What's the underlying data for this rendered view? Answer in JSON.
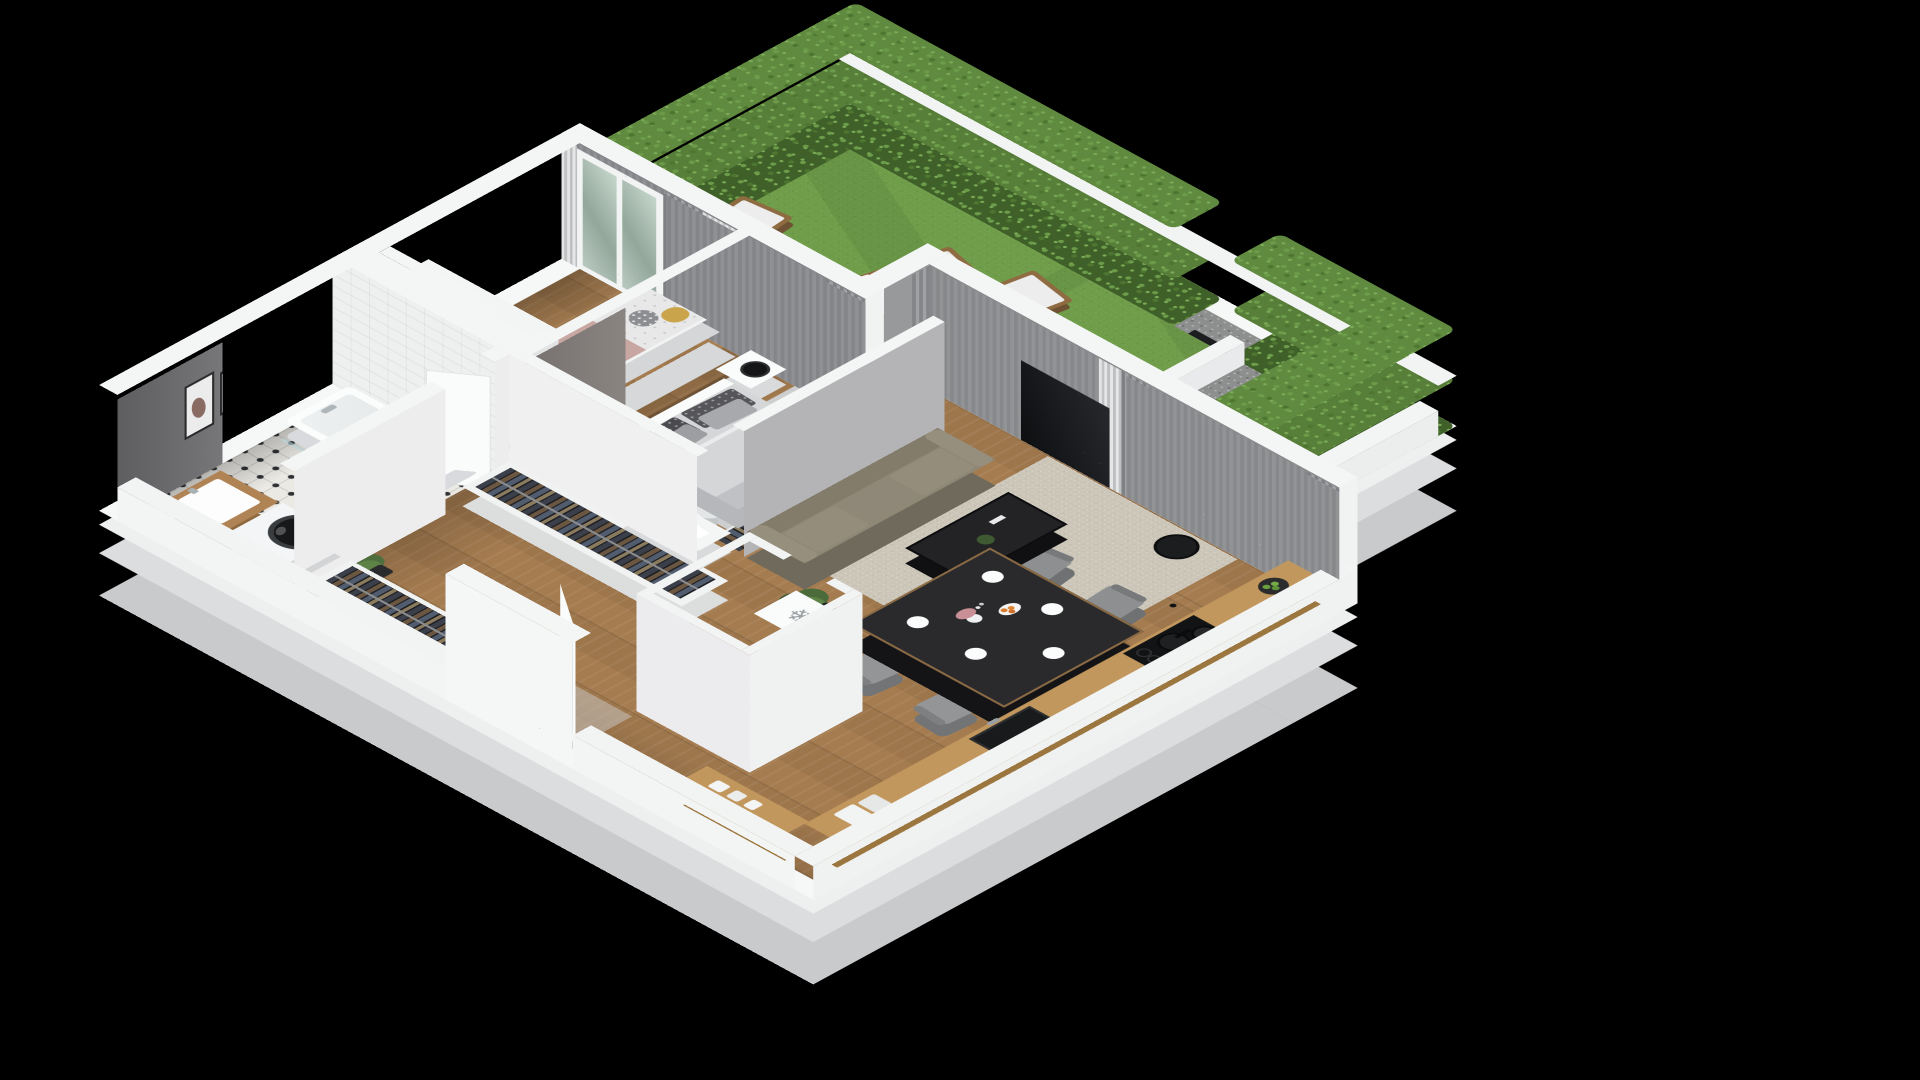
{
  "scene": {
    "kind": "3d-isometric-floor-plan-render",
    "style": "dollhouse cutaway, axonometric view from south",
    "background_color": "#000000",
    "no_visible_text": true
  },
  "icons": {
    "snowflake": "❄"
  },
  "palette": {
    "background": "#000000",
    "wall_white": "#f4f5f5",
    "wall_gray_face": "#7d7d80",
    "wall_mauve_face": "#8e8885",
    "slab_gray": "#c9cacc",
    "wood_floor": "#a57c50",
    "kitchen_counter_wood": "#c2975d",
    "grass_green": "#6f9d49",
    "hedge_green": "#587f3a",
    "sofa_taupe": "#8f8877",
    "rug_beige": "#ccc6b9",
    "rug_gray": "#cdced0",
    "furniture_black": "#232326",
    "accent_pink_bedding": "#c8a7a2",
    "accent_mustard_pillow": "#c9a44a",
    "fruit_orange": "#d97a2e",
    "apple_green": "#69a13f"
  },
  "apartment": {
    "rooms": [
      {
        "id": "bathroom",
        "position": "north-west corner",
        "features": [
          "white tiled walls",
          "black-white patterned tile floor"
        ],
        "furniture": [
          "bathtub with chrome shower mixer",
          "glass splash screen",
          "washbasin on wooden counter cabinet",
          "front-load washing machine",
          "door to hallway"
        ]
      },
      {
        "id": "kids-bedroom",
        "position": "north corner",
        "features": [
          "dark gray feature wall",
          "two framed abstract pictures",
          "balcony door to garden",
          "gray and sheer curtains"
        ],
        "furniture": [
          "white triple-door wardrobe",
          "single bed with pink blanket and white polka-dot duvet",
          "decorative pillows (polka-dot gray, mustard)",
          "white nightstand with toy figure",
          "light gray rug"
        ]
      },
      {
        "id": "master-bedroom",
        "position": "center, garden side",
        "features": [
          "mauve-gray headboard wall",
          "balcony door to garden",
          "gray and sheer curtains"
        ],
        "furniture": [
          "double bed with light gray duvet",
          "patterned dark pillows",
          "nightstand with black table lamp",
          "white nightstand with plant and books",
          "desk with desk lamp and dinosaur figurine",
          "white desk chair",
          "standing oval mirror",
          "open closet with hanging clothes",
          "gray rug"
        ]
      },
      {
        "id": "hallway",
        "position": "south-west spine",
        "furniture": [
          "two long open wardrobes with hanging clothes",
          "potted plant",
          "entrance door with glass strip"
        ]
      },
      {
        "id": "shower-wc",
        "position": "south of hallway",
        "features": [
          "patterned tile floor",
          "white tiled walls"
        ],
        "furniture": [
          "dark glass shower screen",
          "toilet"
        ]
      },
      {
        "id": "kitchen-dining-living",
        "position": "south-east open space",
        "furniture": [
          "fridge unit with snowflake symbol on top",
          "L-shaped wooden counter",
          "black undermount sink",
          "black induction hob with two pans",
          "bowl of green apples",
          "cutting boards",
          "canisters",
          "black dining table set with white plates, cutlery, vase with pink flowers, bowl of oranges",
          "four gray dining chairs",
          "three-seat taupe sofa",
          "black metal coffee table with plant and remote",
          "large beige rug",
          "black floor lamp",
          "potted plant",
          "TV panel on wall",
          "double french doors to garden"
        ]
      }
    ]
  },
  "garden": {
    "position": "north-east strip along full length",
    "elements": [
      "lawn",
      "tall boxwood hedges on three sides",
      "three white sun loungers with wooden frames",
      "gravel strip",
      "low white parapet wall",
      "white terrace border wall",
      "dark privacy screen"
    ]
  },
  "lounger_count": 3,
  "dining_chair_count": 4,
  "wall_picture_count": 2
}
